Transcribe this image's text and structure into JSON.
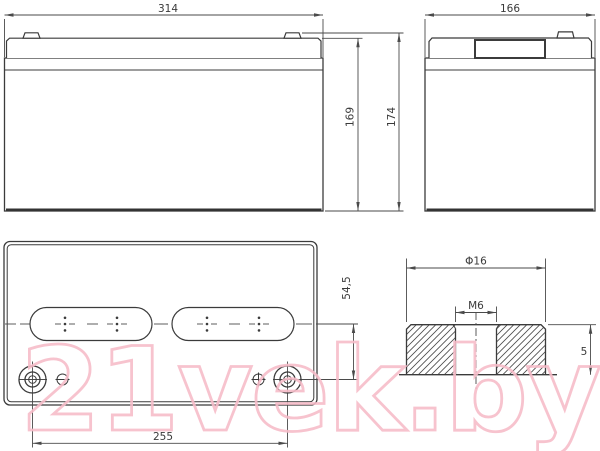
{
  "dimensions": {
    "front_width": "314",
    "side_width": "166",
    "case_height": "169",
    "total_height": "174",
    "terminal_offset": "54,5",
    "terminal_spacing": "255",
    "terminal_diameter": "Φ16",
    "terminal_thread": "M6",
    "terminal_height": "5"
  },
  "watermark": {
    "text": "21vek.by",
    "color": "#f6bdc9"
  },
  "colors": {
    "line": "#3b3b3b",
    "dim_line": "#4a4a4a",
    "text": "#3a3a3a"
  }
}
